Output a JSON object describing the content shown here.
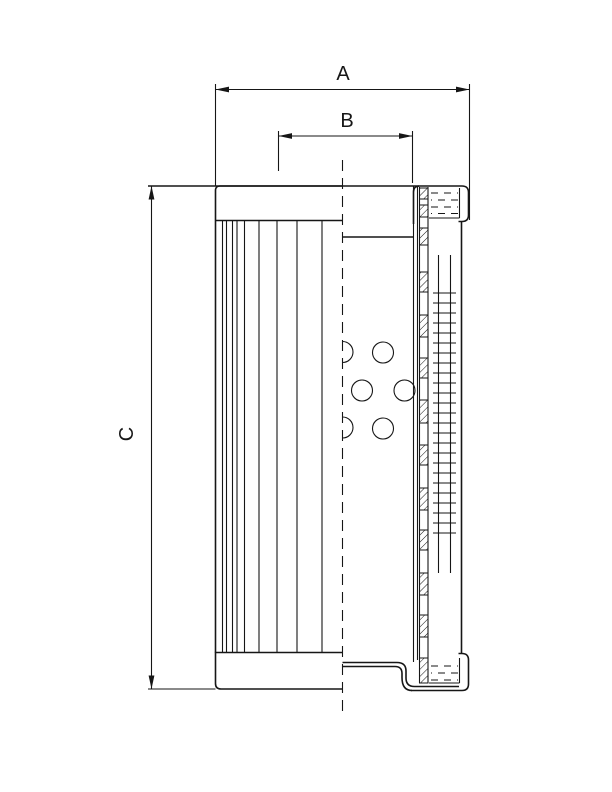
{
  "document": {
    "type": "technical-drawing",
    "subject": "filter-element-cross-section",
    "background_color": "#ffffff",
    "line_color": "#161616"
  },
  "labels": {
    "A": "A",
    "B": "B",
    "C": "C"
  }
}
